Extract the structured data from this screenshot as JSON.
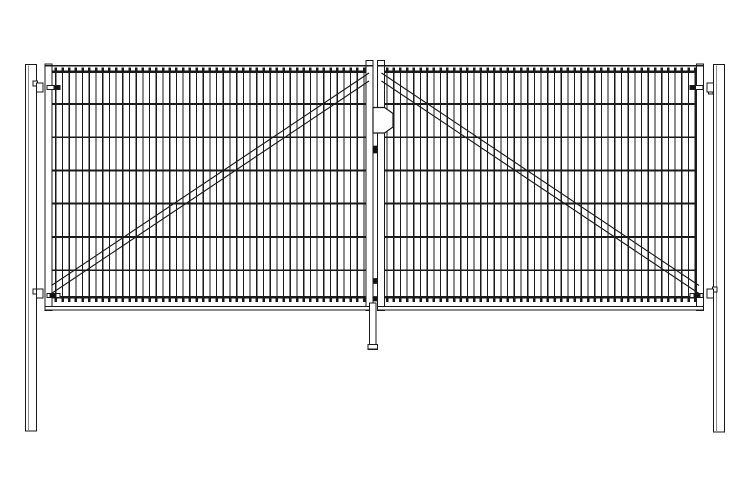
{
  "meta": {
    "type": "technical-line-drawing",
    "subject": "double-leaf wire-mesh fence gate, front elevation",
    "background_color": "#ffffff",
    "line_color": "#1a1a1a",
    "fill_color": "#ffffff",
    "pin_color": "#111111"
  },
  "canvas": {
    "width": 750,
    "height": 500
  },
  "posts": {
    "left": {
      "x": 25.5,
      "y": 64.5,
      "w": 11,
      "h": 366.5,
      "inner_edge_offset": 2.7
    },
    "right": {
      "x": 713.5,
      "y": 64.5,
      "w": 11,
      "h": 367.5,
      "inner_edge_offset": 2.7
    }
  },
  "leaves": {
    "left": {
      "extent": {
        "x1": 45,
        "x2": 373
      },
      "hinge_stile": {
        "x": 45,
        "y": 64,
        "w": 7,
        "h": 246.5
      },
      "lock_stile": {
        "x": 366,
        "y": 60.5,
        "w": 7,
        "h": 250
      },
      "top_rail_y": 65.8,
      "bottom_rail": {
        "x": 45,
        "y": 306.5,
        "w": 328.5,
        "h": 3.5
      },
      "mesh": {
        "x1": 52,
        "x2": 366,
        "wire_start_x": 55.8,
        "wire_spacing": 6.7,
        "wire_count": 47,
        "top_wire_y": 71.8,
        "bottom_wire_y": 297.4,
        "horizontal_wire_ys": [
          71.8,
          103.8,
          137.2,
          170.3,
          203.6,
          236.9,
          270.2,
          297.4
        ]
      },
      "brace": {
        "x1": 51.5,
        "y1a": 285.5,
        "y1b": 293.5,
        "x2": 369,
        "y2a": 73,
        "y2b": 81
      }
    },
    "right": {
      "extent": {
        "x1": 377.5,
        "x2": 703.5
      },
      "hinge_stile": {
        "x": 696.5,
        "y": 64,
        "w": 7,
        "h": 246.5
      },
      "lock_stile": {
        "x": 377.5,
        "y": 60.5,
        "w": 7,
        "h": 250
      },
      "top_rail_y": 65.8,
      "bottom_rail": {
        "x": 377.5,
        "y": 306.5,
        "w": 326,
        "h": 3.5
      },
      "mesh": {
        "x1": 384.5,
        "x2": 696.5,
        "wire_start_x": 387,
        "wire_spacing": 6.7,
        "wire_count": 47,
        "top_wire_y": 71.8,
        "bottom_wire_y": 297.4,
        "horizontal_wire_ys": [
          71.8,
          103.8,
          137.2,
          170.3,
          203.6,
          236.9,
          270.2,
          297.4
        ]
      },
      "brace": {
        "x1": 381.5,
        "y1a": 73,
        "y1b": 81,
        "x2": 699,
        "y2a": 285.5,
        "y2b": 293.5
      }
    }
  },
  "hinges": [
    {
      "id": "hinge-top-left",
      "bracket": {
        "x": 36.5,
        "y": 83,
        "w": 6.5,
        "h": 9
      },
      "tab": {
        "x": 33,
        "y": 81,
        "w": 4.5,
        "h": 5
      },
      "bar": {
        "x": 47,
        "y": 85.5,
        "w": 13,
        "h": 4
      },
      "pin": {
        "x": 54,
        "y": 85.7,
        "w": 5.5,
        "h": 3.6
      }
    },
    {
      "id": "hinge-bottom-left",
      "bracket": {
        "x": 36.5,
        "y": 289,
        "w": 6.5,
        "h": 9
      },
      "tab": {
        "x": 33,
        "y": 289,
        "w": 4.5,
        "h": 5
      },
      "bar": {
        "x": 47,
        "y": 293.5,
        "w": 13,
        "h": 4
      },
      "pin": {
        "x": 50,
        "y": 293.7,
        "w": 6,
        "h": 3.6
      }
    },
    {
      "id": "hinge-top-right",
      "bracket": {
        "x": 707,
        "y": 83,
        "w": 6.5,
        "h": 9
      },
      "tab": {
        "x": 708.5,
        "y": 89,
        "w": 4.5,
        "h": 5
      },
      "bar": {
        "x": 690,
        "y": 85.5,
        "w": 13,
        "h": 4
      },
      "pin": {
        "x": 690.2,
        "y": 85.7,
        "w": 5.5,
        "h": 3.6
      }
    },
    {
      "id": "hinge-bottom-right",
      "bracket": {
        "x": 707,
        "y": 289,
        "w": 6.5,
        "h": 9
      },
      "tab": {
        "x": 712.5,
        "y": 287,
        "w": 4.5,
        "h": 5
      },
      "bar": {
        "x": 690,
        "y": 293.5,
        "w": 13,
        "h": 4
      },
      "pin": {
        "x": 694,
        "y": 293.7,
        "w": 6,
        "h": 3.6
      }
    }
  ],
  "latch": {
    "plate_points": "373,107.5 384.5,107.5 393,113.5 393,127 384.5,133 373,133",
    "bolts": [
      {
        "x": 373,
        "y": 146,
        "w": 4,
        "h": 7
      },
      {
        "x": 373,
        "y": 278.5,
        "w": 4,
        "h": 5
      },
      {
        "x": 373,
        "y": 296.5,
        "w": 4,
        "h": 4.5
      }
    ]
  },
  "drop_rod": {
    "rod": {
      "x": 369.5,
      "y": 303,
      "w": 6.5,
      "h": 42
    },
    "foot": {
      "x": 368,
      "y": 344.5,
      "w": 9.5,
      "h": 4.8
    }
  }
}
